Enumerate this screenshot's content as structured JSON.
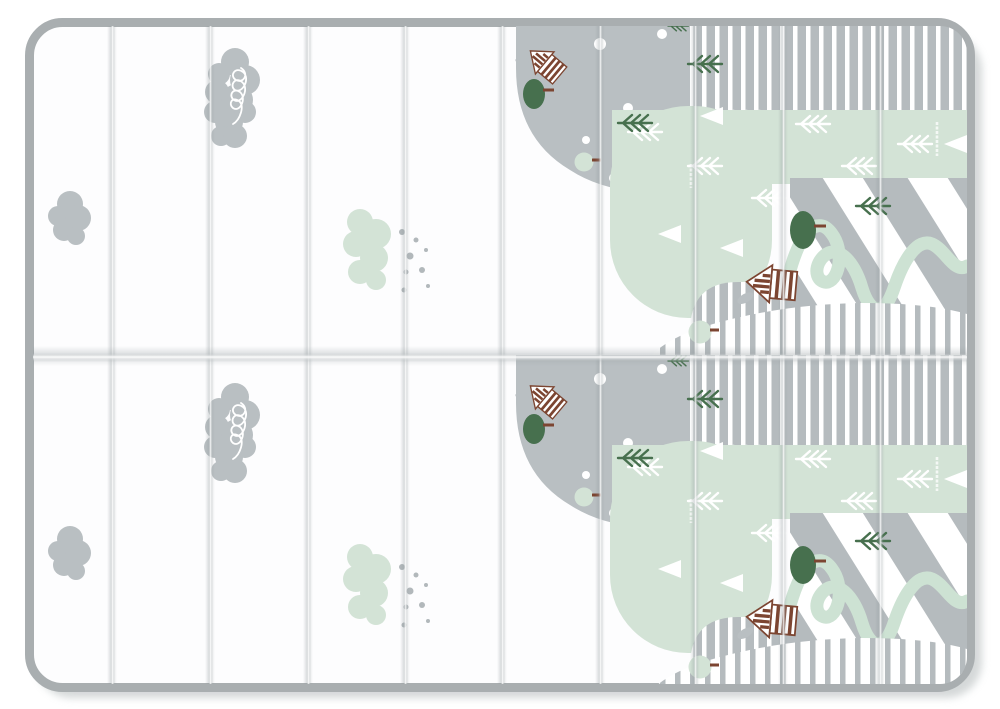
{
  "image": {
    "width": 1000,
    "height": 709,
    "background": "#ffffff"
  },
  "mat": {
    "type": "foldable-play-mat",
    "halves": 2,
    "panels_per_row": 10,
    "crease_positions": [
      112,
      210,
      308,
      405,
      502,
      600,
      695,
      783,
      880
    ],
    "center_fold_y": 355,
    "frame_color": "#a9aeb0",
    "surface_color": "#fdfdfe",
    "shadow_color": "#cdd1d2"
  },
  "palette": {
    "gray": "#b9bfc2",
    "gray_stripe": "#b5bbbe",
    "mint": "#d3e3d6",
    "mint_path": "#cde2d3",
    "dark_green": "#47704e",
    "brown": "#7c4531",
    "speck": "#b2b8bb",
    "white": "#ffffff"
  },
  "motifs": [
    {
      "name": "squiggle-cloud",
      "count": 2
    },
    {
      "name": "plain-cloud",
      "count": 2
    },
    {
      "name": "mint-bush",
      "count": 2
    },
    {
      "name": "speck-dots",
      "count": 2
    },
    {
      "name": "gray-hill-with-dots",
      "count": 2
    },
    {
      "name": "striped-band-top",
      "count": 2
    },
    {
      "name": "mint-hill",
      "count": 2
    },
    {
      "name": "mint-band",
      "count": 2
    },
    {
      "name": "diagonal-stripe-slope",
      "count": 2
    },
    {
      "name": "winding-path",
      "count": 2
    },
    {
      "name": "striped-hill-gray",
      "count": 2
    },
    {
      "name": "striped-hill-thin",
      "count": 2
    },
    {
      "name": "log-cabin-house",
      "count": 4
    },
    {
      "name": "leaf-tree",
      "count": 4
    },
    {
      "name": "round-tree",
      "count": 4
    },
    {
      "name": "fir-twig",
      "count": 14
    },
    {
      "name": "white-triangle",
      "count": 10
    },
    {
      "name": "brand-mark-vertical",
      "count": 4
    }
  ]
}
